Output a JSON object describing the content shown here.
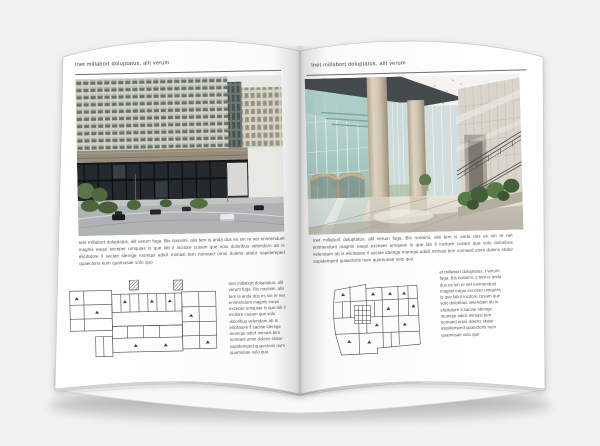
{
  "book": {
    "left_page": {
      "header": "Inet millabort doluptatus, alit verum",
      "body": "Inet millabort doluptatus, alit verum fuga. Bis nossimi, alis tem is anda dus es sin re net enimendunt magnis eaqui exceper umquias is que lab il incitore cusam que volo doloribus velendam ab is elicitatore il saciae idemge mumqui adicil mimasi tem nomaed omni dolens statur sapidemped quaectoris num quamusae volo quo",
      "caption": "Inet millabort doluptatus, alit verum fuga. Bis nossimi, alis tem is anda dus es sin re net enimendunt magnis eaqui exceper umquias is que lab il incitore cusam que volo doloribus velendam ab is elicitatore il saciae idemge mumqui adicil mimasi tem nomaed omni dolens statur sapidemped quaectoris num quamusae volo quo",
      "photo": "Exterior rendering of a modern beige office building with dark glass base, street, cars and trees",
      "floor_plan": "Black line architectural floor plan, elongated building wing"
    },
    "right_page": {
      "header": "Inet millabort doluptatus, alit verum",
      "body": "Inet millabort doluptatus, alit verum fuga. Bis nossimi, alis tem is anda dus es sin re net enimendunt magnis eaqui exceper umquias is que lab il incitore cusam que volo doloribus velendam ab is elicitatore il saciae idemge mumqui adicil mimasi tem nomaed omni dolens statur sapidemped quaectoris num quamusae volo quo",
      "caption": "et millabort doluptatus, t verum fuga. Bis nossimi, s tem is anda dus es sin re net enimendunt magnis eaqui exceper umquias is que lab il incitore cusam que volo doloribus velendam ab is elicitatore il saciae idemge mumqui adicil mimasi tem nomaed omni dolens statur sapidemped quaectoris num quamusae volo que",
      "photo": "Interior rendering of a bright glass lobby atrium with round columns, stone wall, stair railing and plants",
      "floor_plan": "Black line architectural floor plan, compact building block"
    }
  },
  "colors": {
    "background": "#f1f1f2",
    "page": "#fcfcfc",
    "text": "#565656",
    "rule": "#6f6f6f",
    "plan_line": "#4a4a4a"
  }
}
